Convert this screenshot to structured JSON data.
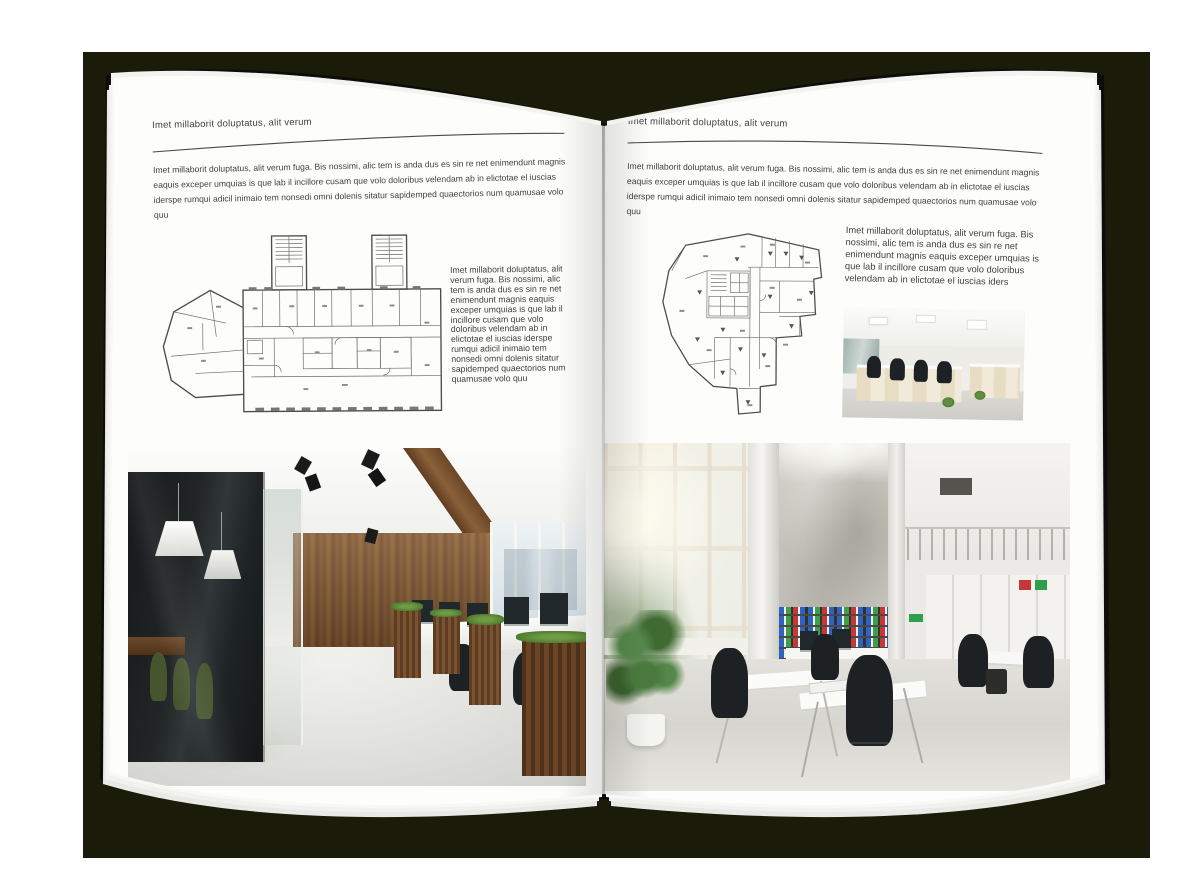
{
  "palette": {
    "backdrop": "#1a1c09",
    "page": "#fdfdfc",
    "cover": "#0c0c0a",
    "body_text": "#3f3f3f",
    "rule": "#4a4a4a",
    "binder_blue": "#2e63c4",
    "binder_green": "#3da049",
    "binder_red": "#c63838"
  },
  "left_page": {
    "header": "Imet millaborit doluptatus, alit verum",
    "intro": "Imet millaborit doluptatus, alit verum fuga. Bis nossimi, alic tem is anda dus es sin re net enimendunt magnis eaquis exceper umquias is que lab il incillore cusam que volo doloribus velendam ab in elictotae el iuscias iderspe rumqui adicil inimaio tem nonsedi omni dolenis sitatur sapidemped quaectorios num quamusae volo quu",
    "side_text": "Imet millaborit doluptatus, alit verum fuga. Bis nossimi, alic tem is anda dus es sin re net enimendunt magnis eaquis exceper umquias is que lab il incillore cusam que volo doloribus velendam ab in elictotae el iuscias iderspe rumqui adicil inimaio tem nonsedi omni dolenis sitatur sapidemped quaectorios num quamusae volo quu"
  },
  "right_page": {
    "header": "Imet millaborit doluptatus, alit verum",
    "intro": "Imet millaborit doluptatus, alit verum fuga. Bis nossimi, alic tem is anda dus es sin re net enimendunt magnis eaquis exceper umquias is que lab il incillore cusam que volo doloribus velendam ab in elictotae el iuscias iderspe rumqui adicil inimaio tem nonsedi omni dolenis sitatur sapidemped quaectorios num quamusae volo quu",
    "side_text": "Imet millaborit doluptatus, alit verum fuga. Bis nossimi, alic tem is anda dus es sin re net enimendunt magnis eaquis exceper umquias is que lab il incillore cusam que volo doloribus velendam ab in elictotae el iuscias iders"
  }
}
